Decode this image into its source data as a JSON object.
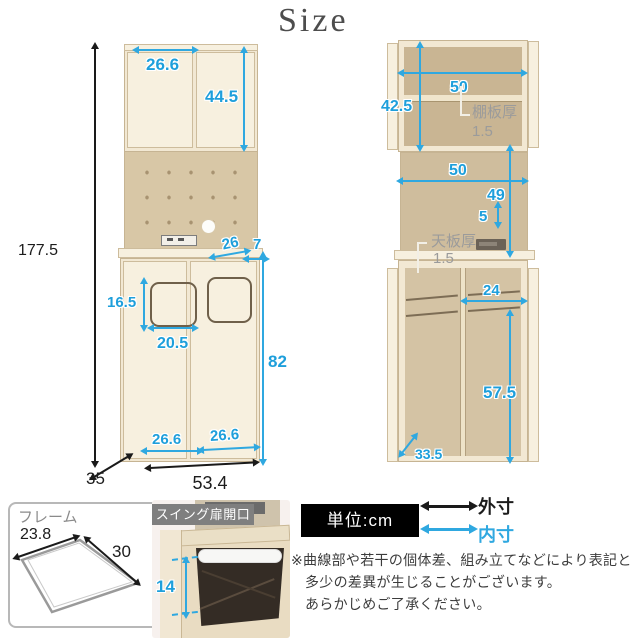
{
  "title": "Size",
  "front": {
    "overall_height": "177.5",
    "overall_width": "53.4",
    "overall_depth": "35",
    "upper_door_width": "26.6",
    "upper_door_height": "44.5",
    "shelf_depth": "26",
    "counter_edge": "7",
    "handle_height": "16.5",
    "handle_width": "20.5",
    "lower_height": "82",
    "lower_left_door_width": "26.6",
    "lower_right_door_width": "26.6"
  },
  "open": {
    "upper_inner_height": "42.5",
    "upper_inner_width": "50",
    "shelf_thickness_label": "棚板厚",
    "shelf_thickness": "1.5",
    "mid_inner_width": "50",
    "mid_inner_height": "49",
    "mid_gap": "5",
    "top_thickness_label": "天板厚",
    "top_thickness": "1.5",
    "lower_compartment_width": "24",
    "lower_inner_height": "57.5",
    "lower_inner_depth": "33.5"
  },
  "frame": {
    "label": "フレーム",
    "width": "23.8",
    "depth": "30"
  },
  "swing": {
    "label": "スイング扉開口",
    "opening_height": "14"
  },
  "legend": {
    "unit": "単位:cm",
    "outer": "外寸",
    "inner": "内寸"
  },
  "note": {
    "line1": "※曲線部や若干の個体差、組み立てなどにより表記と",
    "line2": "多少の差異が生じることがございます。",
    "line3": "あらかじめご了承ください。"
  },
  "colors": {
    "inner_dim": "#2FA8E0",
    "outer_dim": "#1A1A1A",
    "wood_light": "#F2E8D3",
    "wood_interior": "#C9B593"
  }
}
